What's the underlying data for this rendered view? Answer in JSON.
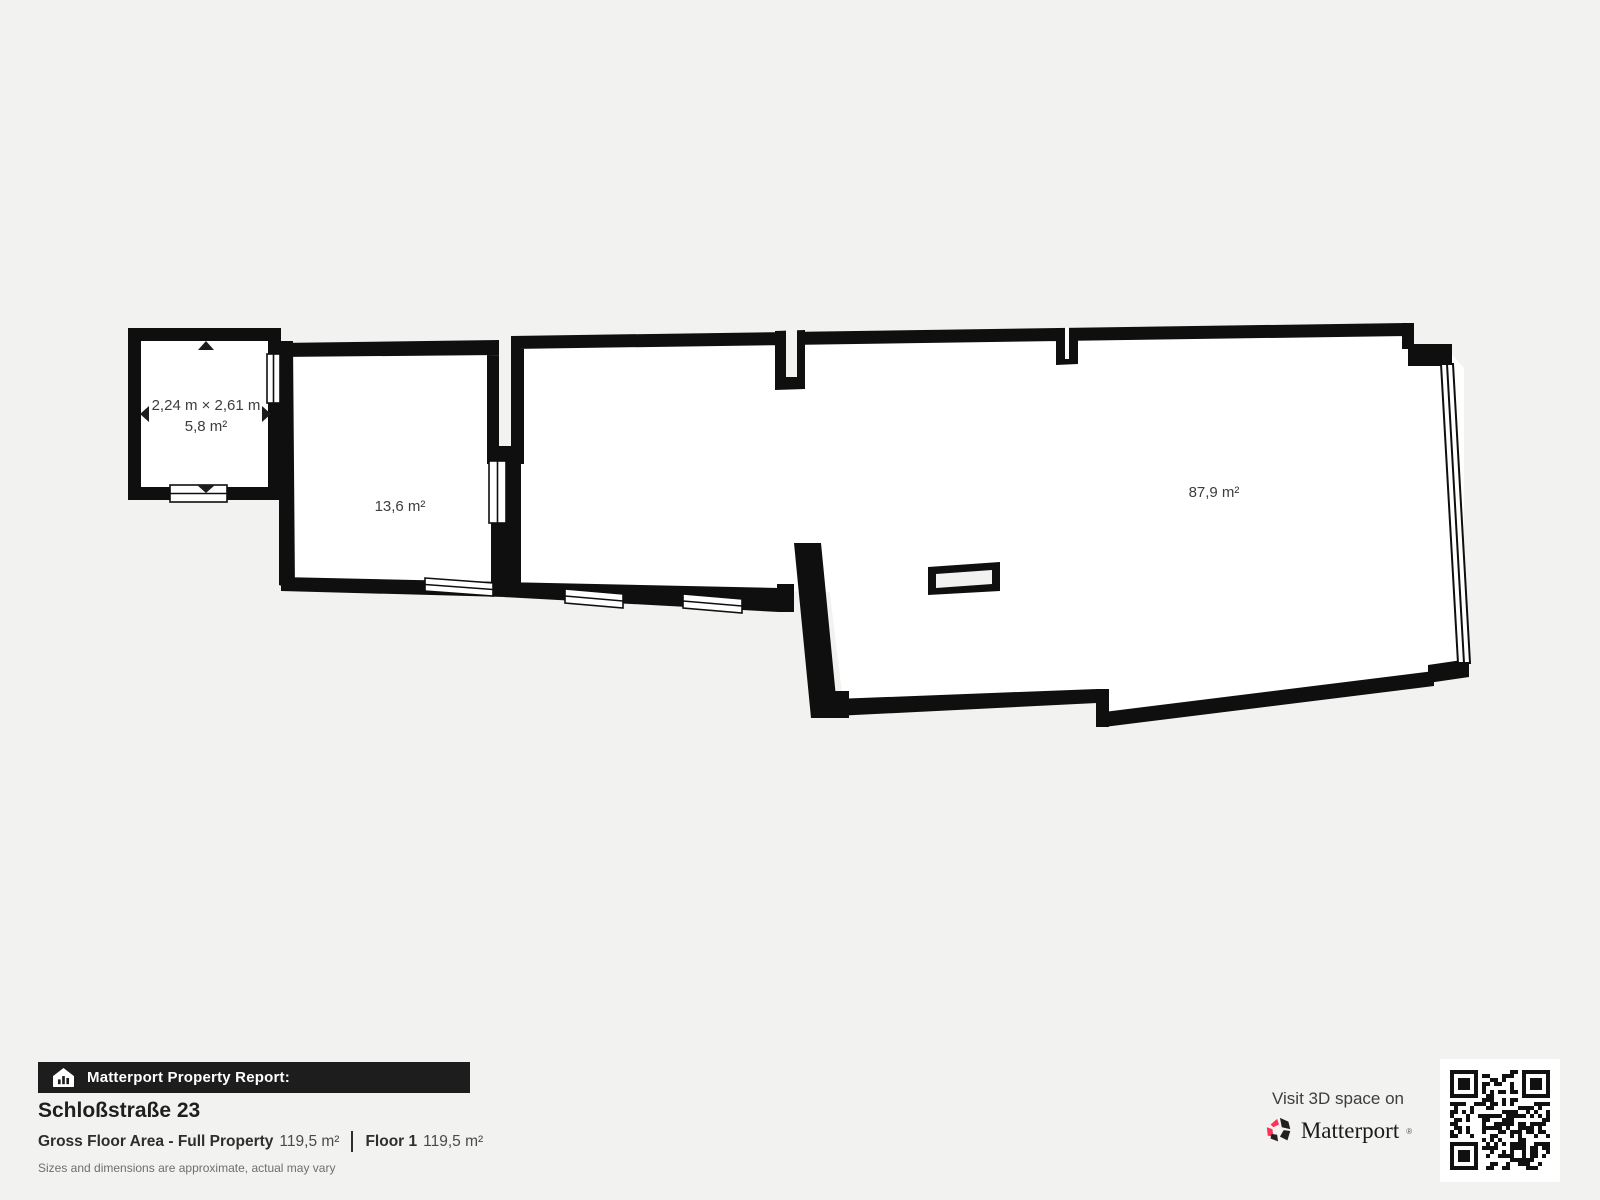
{
  "colors": {
    "background": "#f2f2f0",
    "wall": "#0f0f0f",
    "room_fill": "#ffffff",
    "label_text": "#3d3d3d",
    "banner_bg": "#1d1d1d",
    "brand_red": "#ff3158"
  },
  "floorplan": {
    "rooms": [
      {
        "name": "small-room",
        "dimensions": "2,24 m × 2,61 m",
        "area": "5,8 m²"
      },
      {
        "name": "middle-room",
        "area": "13,6 m²"
      },
      {
        "name": "main-room",
        "area": "87,9 m²"
      }
    ]
  },
  "footer": {
    "banner": "Matterport Property Report:",
    "address": "Schloßstraße 23",
    "gross_floor_label": "Gross Floor Area - Full Property",
    "gross_floor_value": "119,5 m²",
    "floor_label": "Floor 1",
    "floor_value": "119,5 m²",
    "disclaimer": "Sizes and dimensions are approximate, actual may vary"
  },
  "cta": {
    "visit_text": "Visit 3D space on",
    "brand": "Matterport",
    "brand_mark": "®"
  }
}
